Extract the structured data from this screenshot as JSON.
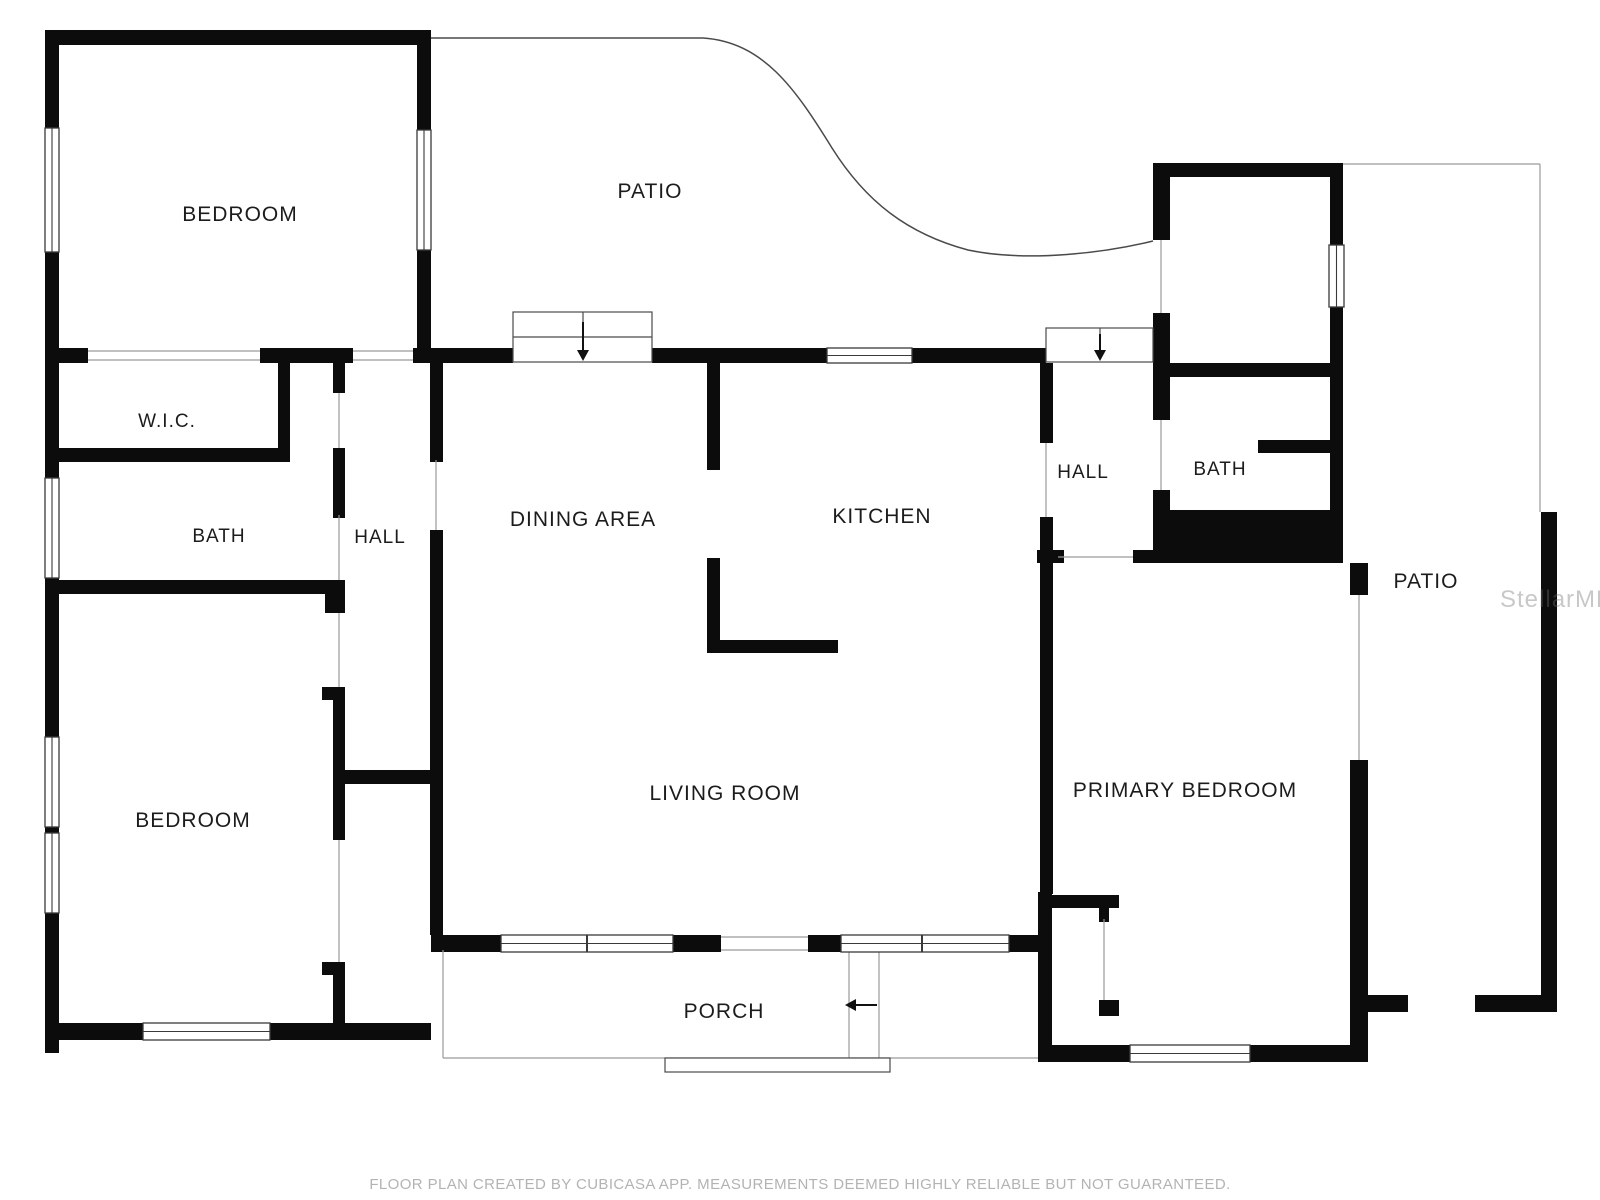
{
  "footer": {
    "text": "FLOOR PLAN CREATED BY CUBICASA APP. MEASUREMENTS DEEMED HIGHLY RELIABLE BUT NOT GUARANTEED."
  },
  "watermark": {
    "text": "StellarMLS"
  },
  "floorplan": {
    "canvas": {
      "width": 1600,
      "height": 1200
    },
    "colors": {
      "wall": "#0c0c0c",
      "thin": "#4a4a4a",
      "opening": "#9a9a9a",
      "window_frame": "#3a3a3a",
      "label": "#1c1c1c",
      "arrow": "#111111"
    },
    "rooms": [
      {
        "id": "bedroom-top-left",
        "label": "BEDROOM",
        "x": 240,
        "y": 221,
        "fs": 21
      },
      {
        "id": "patio-top",
        "label": "PATIO",
        "x": 650,
        "y": 198,
        "fs": 21
      },
      {
        "id": "wic",
        "label": "W.I.C.",
        "x": 167,
        "y": 427,
        "fs": 19
      },
      {
        "id": "bath-left",
        "label": "BATH",
        "x": 219,
        "y": 542,
        "fs": 19
      },
      {
        "id": "hall-left",
        "label": "HALL",
        "x": 380,
        "y": 543,
        "fs": 19
      },
      {
        "id": "dining-area",
        "label": "DINING AREA",
        "x": 583,
        "y": 526,
        "fs": 21
      },
      {
        "id": "kitchen",
        "label": "KITCHEN",
        "x": 882,
        "y": 523,
        "fs": 21
      },
      {
        "id": "hall-right",
        "label": "HALL",
        "x": 1083,
        "y": 478,
        "fs": 19
      },
      {
        "id": "bath-right",
        "label": "BATH",
        "x": 1220,
        "y": 475,
        "fs": 19
      },
      {
        "id": "patio-right",
        "label": "PATIO",
        "x": 1426,
        "y": 588,
        "fs": 21
      },
      {
        "id": "bedroom-bottom-left",
        "label": "BEDROOM",
        "x": 193,
        "y": 827,
        "fs": 21
      },
      {
        "id": "living-room",
        "label": "LIVING ROOM",
        "x": 725,
        "y": 800,
        "fs": 21
      },
      {
        "id": "primary-bedroom",
        "label": "PRIMARY BEDROOM",
        "x": 1185,
        "y": 797,
        "fs": 21
      },
      {
        "id": "porch",
        "label": "PORCH",
        "x": 724,
        "y": 1018,
        "fs": 21
      }
    ],
    "walls": [
      [
        45,
        30,
        386,
        15
      ],
      [
        45,
        30,
        14,
        100
      ],
      [
        45,
        250,
        14,
        112
      ],
      [
        417,
        30,
        14,
        100
      ],
      [
        417,
        248,
        14,
        115
      ],
      [
        45,
        348,
        43,
        15
      ],
      [
        260,
        348,
        93,
        15
      ],
      [
        413,
        348,
        18,
        15
      ],
      [
        45,
        363,
        14,
        87
      ],
      [
        45,
        448,
        245,
        14
      ],
      [
        278,
        363,
        12,
        87
      ],
      [
        333,
        363,
        12,
        30
      ],
      [
        45,
        448,
        14,
        32
      ],
      [
        45,
        578,
        14,
        26
      ],
      [
        45,
        580,
        300,
        14
      ],
      [
        333,
        448,
        12,
        70
      ],
      [
        430,
        363,
        13,
        99
      ],
      [
        430,
        530,
        13,
        405
      ],
      [
        345,
        770,
        98,
        14
      ],
      [
        322,
        687,
        23,
        13
      ],
      [
        333,
        700,
        12,
        140
      ],
      [
        325,
        588,
        20,
        25
      ],
      [
        322,
        962,
        23,
        13
      ],
      [
        333,
        962,
        12,
        75
      ],
      [
        45,
        594,
        14,
        145
      ],
      [
        45,
        825,
        14,
        8
      ],
      [
        45,
        913,
        14,
        140
      ],
      [
        45,
        1023,
        98,
        17
      ],
      [
        270,
        1023,
        161,
        17
      ],
      [
        431,
        348,
        82,
        15
      ],
      [
        652,
        348,
        175,
        15
      ],
      [
        912,
        348,
        134,
        15
      ],
      [
        707,
        363,
        13,
        107
      ],
      [
        707,
        558,
        13,
        95
      ],
      [
        707,
        640,
        131,
        13
      ],
      [
        1040,
        363,
        13,
        80
      ],
      [
        1040,
        517,
        13,
        377
      ],
      [
        1037,
        550,
        27,
        13
      ],
      [
        1038,
        892,
        14,
        170
      ],
      [
        1052,
        895,
        67,
        13
      ],
      [
        1099,
        908,
        10,
        14
      ],
      [
        1099,
        1000,
        20,
        16
      ],
      [
        1133,
        550,
        25,
        13
      ],
      [
        1153,
        510,
        190,
        53
      ],
      [
        1153,
        163,
        190,
        14
      ],
      [
        1153,
        163,
        17,
        77
      ],
      [
        1153,
        313,
        17,
        64
      ],
      [
        1330,
        163,
        13,
        82
      ],
      [
        1330,
        307,
        13,
        133
      ],
      [
        1170,
        363,
        160,
        14
      ],
      [
        1153,
        377,
        17,
        43
      ],
      [
        1153,
        490,
        17,
        22
      ],
      [
        1258,
        440,
        72,
        13
      ],
      [
        1330,
        440,
        13,
        72
      ],
      [
        1350,
        563,
        18,
        32
      ],
      [
        1350,
        760,
        18,
        302
      ],
      [
        1038,
        1045,
        92,
        17
      ],
      [
        1250,
        1045,
        118,
        17
      ],
      [
        1368,
        995,
        40,
        17
      ],
      [
        1475,
        995,
        82,
        17
      ],
      [
        1541,
        512,
        16,
        500
      ],
      [
        431,
        935,
        70,
        17
      ],
      [
        673,
        935,
        48,
        17
      ],
      [
        808,
        935,
        33,
        17
      ],
      [
        1009,
        935,
        31,
        17
      ]
    ],
    "windows": [
      {
        "x": 45,
        "y": 128,
        "w": 14,
        "h": 124,
        "o": "v",
        "div": []
      },
      {
        "x": 417,
        "y": 130,
        "w": 14,
        "h": 120,
        "o": "v",
        "div": []
      },
      {
        "x": 45,
        "y": 478,
        "w": 14,
        "h": 100,
        "o": "v",
        "div": []
      },
      {
        "x": 45,
        "y": 737,
        "w": 14,
        "h": 90,
        "o": "v",
        "div": []
      },
      {
        "x": 45,
        "y": 833,
        "w": 14,
        "h": 80,
        "o": "v",
        "div": []
      },
      {
        "x": 143,
        "y": 1023,
        "w": 127,
        "h": 17,
        "o": "h",
        "div": []
      },
      {
        "x": 827,
        "y": 348,
        "w": 85,
        "h": 15,
        "o": "h",
        "div": []
      },
      {
        "x": 501,
        "y": 935,
        "w": 172,
        "h": 17,
        "o": "h",
        "div": [
          587
        ]
      },
      {
        "x": 841,
        "y": 935,
        "w": 168,
        "h": 17,
        "o": "h",
        "div": [
          922
        ]
      },
      {
        "x": 1130,
        "y": 1045,
        "w": 120,
        "h": 17,
        "o": "h",
        "div": []
      },
      {
        "x": 1329,
        "y": 245,
        "w": 15,
        "h": 62,
        "o": "v",
        "div": []
      }
    ],
    "thin_lines": [
      [
        88,
        351,
        260,
        351
      ],
      [
        88,
        360,
        260,
        360
      ],
      [
        353,
        351,
        413,
        351
      ],
      [
        353,
        360,
        413,
        360
      ],
      [
        339,
        393,
        339,
        448
      ],
      [
        339,
        515,
        339,
        580
      ],
      [
        339,
        613,
        339,
        687
      ],
      [
        339,
        840,
        339,
        962
      ],
      [
        436,
        460,
        436,
        530
      ],
      [
        1046,
        443,
        1046,
        517
      ],
      [
        1058,
        557,
        1133,
        557
      ],
      [
        1161,
        420,
        1161,
        490
      ],
      [
        1161,
        240,
        1161,
        313
      ],
      [
        1104,
        919,
        1104,
        1000
      ],
      [
        1359,
        595,
        1359,
        760
      ],
      [
        721,
        937,
        808,
        937
      ],
      [
        721,
        950,
        808,
        950
      ],
      [
        443,
        950,
        443,
        1058
      ],
      [
        443,
        1058,
        1038,
        1058
      ],
      [
        849,
        952,
        849,
        1058
      ],
      [
        879,
        952,
        879,
        1058
      ],
      [
        1343,
        164,
        1540,
        164
      ],
      [
        1540,
        164,
        1540,
        512
      ]
    ],
    "thin_rects": [
      [
        665,
        1058,
        225,
        14
      ]
    ],
    "curves": [
      "M431,38 L703,38 C763,42 795,88 832,148 C866,202 908,234 968,250 C1030,263 1108,252 1153,241"
    ],
    "sliders": [
      {
        "box": [
          513,
          312,
          139,
          50
        ],
        "hline": [
          513,
          337,
          652,
          337
        ],
        "vline": [
          583,
          312,
          583,
          337
        ]
      },
      {
        "box": [
          1046,
          328,
          107,
          34
        ],
        "hline": null,
        "vline": [
          1100,
          328,
          1100,
          348
        ]
      }
    ],
    "arrows": [
      {
        "shaft": [
          583,
          322,
          583,
          350
        ],
        "head": [
          [
            577,
            350
          ],
          [
            589,
            350
          ],
          [
            583,
            361
          ]
        ]
      },
      {
        "shaft": [
          1100,
          334,
          1100,
          350
        ],
        "head": [
          [
            1094,
            350
          ],
          [
            1106,
            350
          ],
          [
            1100,
            361
          ]
        ]
      },
      {
        "shaft": [
          877,
          1005,
          856,
          1005
        ],
        "head": [
          [
            856,
            999
          ],
          [
            856,
            1011
          ],
          [
            845,
            1005
          ]
        ]
      }
    ]
  }
}
